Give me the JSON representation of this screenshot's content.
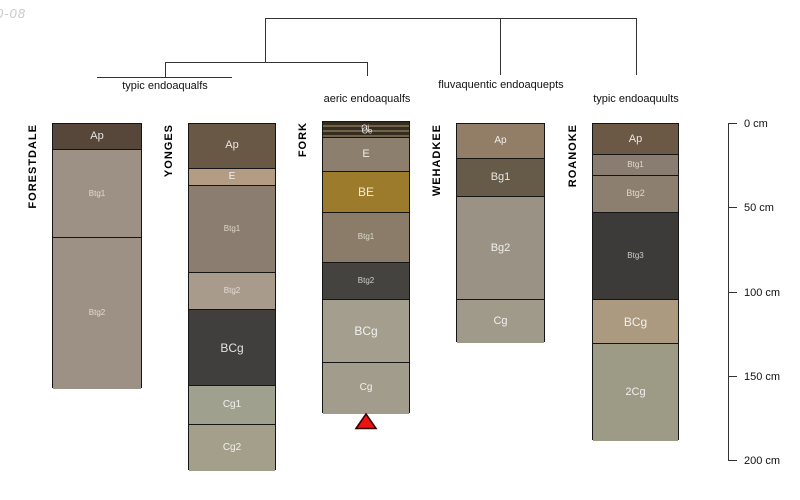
{
  "watermark": "0-08",
  "chart_data": {
    "type": "soil-profile-sketches-with-dendrogram",
    "depth_unit": "cm",
    "depth_range": [
      0,
      200
    ],
    "depth_ticks": [
      {
        "value": 0,
        "label": "0 cm"
      },
      {
        "value": 50,
        "label": "50 cm"
      },
      {
        "value": 100,
        "label": "100 cm"
      },
      {
        "value": 150,
        "label": "150 cm"
      },
      {
        "value": 200,
        "label": "200 cm"
      }
    ],
    "dendrogram_topology": "((typic endoaqualfs[FORESTDALE,YONGES] , aeric endoaqualfs[FORK]) , fluvaquentic endoaquepts[WEHADKEE] , typic endoaquults[ROANOKE])",
    "groups": [
      {
        "label": "typic endoaqualfs",
        "members": [
          "FORESTDALE",
          "YONGES"
        ]
      },
      {
        "label": "aeric endoaqualfs",
        "members": [
          "FORK"
        ]
      },
      {
        "label": "fluvaquentic endoaquepts",
        "members": [
          "WEHADKEE"
        ]
      },
      {
        "label": "typic endoaquults",
        "members": [
          "ROANOKE"
        ]
      }
    ],
    "marker": {
      "symbol": "filled-triangle-up",
      "color": "#ee1313",
      "below_profile": "FORK"
    },
    "profiles": [
      {
        "name": "FORESTDALE",
        "group": "typic endoaqualfs",
        "horizons": [
          {
            "name": "Ap",
            "top": 0,
            "bottom": 15,
            "color": "#57473a"
          },
          {
            "name": "Btg1",
            "top": 15,
            "bottom": 67,
            "color": "#9c9184"
          },
          {
            "name": "Btg2",
            "top": 67,
            "bottom": 157,
            "color": "#9c9184"
          }
        ]
      },
      {
        "name": "YONGES",
        "group": "typic endoaqualfs",
        "horizons": [
          {
            "name": "Ap",
            "top": 0,
            "bottom": 26,
            "color": "#6a5846"
          },
          {
            "name": "E",
            "top": 26,
            "bottom": 36,
            "color": "#b29c83"
          },
          {
            "name": "Btg1",
            "top": 36,
            "bottom": 88,
            "color": "#8b7d6f"
          },
          {
            "name": "Btg2",
            "top": 88,
            "bottom": 110,
            "color": "#a99b8c"
          },
          {
            "name": "BCg",
            "top": 110,
            "bottom": 155,
            "color": "#403f3d"
          },
          {
            "name": "Cg1",
            "top": 155,
            "bottom": 178,
            "color": "#9fa18e"
          },
          {
            "name": "Cg2",
            "top": 178,
            "bottom": 206,
            "color": "#a49f8b"
          }
        ]
      },
      {
        "name": "FORK",
        "group": "aeric endoaqualfs",
        "marker": "filled-triangle-up",
        "horizons": [
          {
            "name": "Oi/Oe",
            "labels": [
              "Oi",
              "Oe"
            ],
            "top": -1,
            "bottom": 8,
            "striped": true,
            "stripe_colors": [
              "#342d20",
              "#73624a"
            ],
            "color": "#342d20"
          },
          {
            "name": "E",
            "top": 8,
            "bottom": 28,
            "color": "#8d7f6e"
          },
          {
            "name": "BE",
            "top": 28,
            "bottom": 52,
            "color": "#9c7b2d"
          },
          {
            "name": "Btg1",
            "top": 52,
            "bottom": 82,
            "color": "#8a7c68"
          },
          {
            "name": "Btg2",
            "top": 82,
            "bottom": 104,
            "color": "#454340"
          },
          {
            "name": "BCg",
            "top": 104,
            "bottom": 141,
            "color": "#a49e8e"
          },
          {
            "name": "Cg",
            "top": 141,
            "bottom": 172,
            "color": "#a29c8c"
          }
        ]
      },
      {
        "name": "WEHADKEE",
        "group": "fluvaquentic endoaquepts",
        "horizons": [
          {
            "name": "Ap",
            "top": 0,
            "bottom": 20,
            "color": "#927e67"
          },
          {
            "name": "Bg1",
            "top": 20,
            "bottom": 43,
            "color": "#665b49"
          },
          {
            "name": "Bg2",
            "top": 43,
            "bottom": 104,
            "color": "#9b9286"
          },
          {
            "name": "Cg",
            "top": 104,
            "bottom": 130,
            "color": "#a09a8b"
          }
        ]
      },
      {
        "name": "ROANOKE",
        "group": "typic endoaquults",
        "horizons": [
          {
            "name": "Ap",
            "top": 0,
            "bottom": 18,
            "color": "#6b5845"
          },
          {
            "name": "Btg1",
            "top": 18,
            "bottom": 30,
            "color": "#897d71"
          },
          {
            "name": "Btg2",
            "top": 30,
            "bottom": 52,
            "color": "#8d7f6f"
          },
          {
            "name": "Btg3",
            "top": 52,
            "bottom": 104,
            "color": "#3d3b39"
          },
          {
            "name": "BCg",
            "top": 104,
            "bottom": 130,
            "color": "#ab9a7f"
          },
          {
            "name": "2Cg",
            "top": 130,
            "bottom": 188,
            "color": "#9d9a86"
          }
        ]
      }
    ]
  }
}
